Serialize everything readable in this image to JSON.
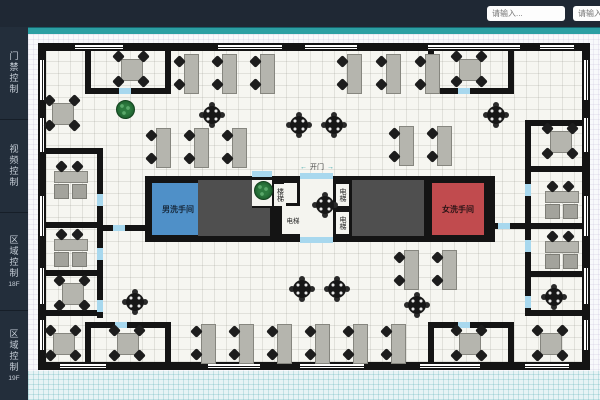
{
  "topbar": {
    "inputs": [
      {
        "placeholder": "请输入..."
      },
      {
        "placeholder": "请输入..."
      }
    ]
  },
  "sidebar": {
    "items": [
      {
        "label": "门禁控制",
        "sub": ""
      },
      {
        "label": "视频控制",
        "sub": ""
      },
      {
        "label": "区域控制",
        "sub": "18F"
      },
      {
        "label": "区域控制",
        "sub": "19F"
      }
    ]
  },
  "floorplan": {
    "labels": {
      "mens_room": "男洗手间",
      "womens_room": "女洗手间",
      "elevator_room": "电梯",
      "shaft_label_1": "电梯",
      "shaft_label_2": "电梯",
      "stairs": "楼梯",
      "open_door": "开门",
      "arrow_left": "←",
      "arrow_right": "→"
    },
    "colors": {
      "topbar_bg": "#1f2834",
      "sidebar_bg": "#232e3b",
      "accent_stripe": "#2b9fa3",
      "wall": "#141414",
      "mens_room": "#4f90c8",
      "womens_room": "#c14b4e",
      "shaft": "#4f4f4f",
      "door_marker": "#a8d8ee",
      "plant": "#1d5e2d"
    },
    "walls": [
      [
        38,
        43,
        552,
        8
      ],
      [
        38,
        362,
        552,
        8
      ],
      [
        38,
        43,
        8,
        327
      ],
      [
        582,
        43,
        8,
        327
      ],
      [
        85,
        43,
        6,
        51
      ],
      [
        85,
        88,
        34,
        6
      ],
      [
        131,
        88,
        40,
        6
      ],
      [
        165,
        43,
        6,
        51
      ],
      [
        428,
        43,
        6,
        51
      ],
      [
        428,
        88,
        30,
        6
      ],
      [
        470,
        88,
        44,
        6
      ],
      [
        508,
        43,
        6,
        51
      ],
      [
        85,
        322,
        6,
        46
      ],
      [
        85,
        322,
        30,
        6
      ],
      [
        127,
        322,
        44,
        6
      ],
      [
        165,
        322,
        6,
        46
      ],
      [
        428,
        322,
        30,
        6
      ],
      [
        470,
        322,
        44,
        6
      ],
      [
        428,
        322,
        6,
        46
      ],
      [
        508,
        322,
        6,
        46
      ],
      [
        97,
        148,
        6,
        46
      ],
      [
        97,
        206,
        6,
        42
      ],
      [
        97,
        260,
        6,
        40
      ],
      [
        97,
        312,
        6,
        6
      ],
      [
        46,
        148,
        51,
        6
      ],
      [
        46,
        222,
        51,
        6
      ],
      [
        46,
        270,
        51,
        6
      ],
      [
        46,
        310,
        51,
        6
      ],
      [
        525,
        120,
        57,
        6
      ],
      [
        525,
        120,
        6,
        64
      ],
      [
        525,
        196,
        6,
        44
      ],
      [
        525,
        252,
        6,
        44
      ],
      [
        525,
        308,
        6,
        8
      ],
      [
        531,
        166,
        51,
        6
      ],
      [
        531,
        223,
        51,
        6
      ],
      [
        531,
        271,
        51,
        6
      ],
      [
        531,
        310,
        51,
        6
      ],
      [
        103,
        225,
        42,
        6
      ],
      [
        487,
        223,
        38,
        6
      ]
    ],
    "windows": [
      [
        75,
        44,
        48,
        6,
        "h"
      ],
      [
        218,
        44,
        64,
        6,
        "h"
      ],
      [
        305,
        44,
        52,
        6,
        "h"
      ],
      [
        428,
        44,
        92,
        6,
        "h"
      ],
      [
        540,
        44,
        34,
        6,
        "h"
      ],
      [
        60,
        363,
        46,
        6,
        "h"
      ],
      [
        208,
        363,
        52,
        6,
        "h"
      ],
      [
        300,
        363,
        64,
        6,
        "h"
      ],
      [
        420,
        363,
        60,
        6,
        "h"
      ],
      [
        525,
        363,
        44,
        6,
        "h"
      ],
      [
        39,
        60,
        6,
        40,
        "v"
      ],
      [
        39,
        118,
        6,
        34,
        "v"
      ],
      [
        39,
        196,
        6,
        40,
        "v"
      ],
      [
        39,
        268,
        6,
        36,
        "v"
      ],
      [
        39,
        320,
        6,
        30,
        "v"
      ],
      [
        583,
        60,
        6,
        40,
        "v"
      ],
      [
        583,
        118,
        6,
        34,
        "v"
      ],
      [
        583,
        196,
        6,
        40,
        "v"
      ],
      [
        583,
        268,
        6,
        36,
        "v"
      ],
      [
        583,
        320,
        6,
        30,
        "v"
      ]
    ],
    "doors": [
      [
        119,
        88,
        12,
        6
      ],
      [
        458,
        88,
        12,
        6
      ],
      [
        115,
        322,
        12,
        6
      ],
      [
        458,
        322,
        12,
        6
      ],
      [
        97,
        194,
        6,
        12
      ],
      [
        97,
        248,
        6,
        12
      ],
      [
        97,
        300,
        6,
        12
      ],
      [
        525,
        184,
        6,
        12
      ],
      [
        525,
        240,
        6,
        12
      ],
      [
        525,
        296,
        6,
        12
      ],
      [
        300,
        173,
        33,
        6
      ],
      [
        300,
        237,
        33,
        6
      ],
      [
        252,
        171,
        20,
        6
      ],
      [
        113,
        225,
        12,
        6
      ],
      [
        498,
        223,
        12,
        6
      ]
    ],
    "furniture": [
      {
        "t": "q",
        "x": 114,
        "y": 52
      },
      {
        "t": "q",
        "x": 452,
        "y": 52
      },
      {
        "t": "q",
        "x": 543,
        "y": 124
      },
      {
        "t": "q",
        "x": 45,
        "y": 96
      },
      {
        "t": "q",
        "x": 55,
        "y": 276
      },
      {
        "t": "q",
        "x": 110,
        "y": 326
      },
      {
        "t": "q",
        "x": 46,
        "y": 326
      },
      {
        "t": "q",
        "x": 452,
        "y": 326
      },
      {
        "t": "q",
        "x": 533,
        "y": 326
      },
      {
        "t": "o",
        "x": 50,
        "y": 162
      },
      {
        "t": "o",
        "x": 50,
        "y": 230
      },
      {
        "t": "o",
        "x": 541,
        "y": 182
      },
      {
        "t": "o",
        "x": 541,
        "y": 232
      },
      {
        "t": "d",
        "x": 175,
        "y": 54
      },
      {
        "t": "d",
        "x": 213,
        "y": 54
      },
      {
        "t": "d",
        "x": 251,
        "y": 54
      },
      {
        "t": "d",
        "x": 338,
        "y": 54
      },
      {
        "t": "d",
        "x": 377,
        "y": 54
      },
      {
        "t": "d",
        "x": 416,
        "y": 54
      },
      {
        "t": "d",
        "x": 147,
        "y": 128
      },
      {
        "t": "d",
        "x": 185,
        "y": 128
      },
      {
        "t": "d",
        "x": 223,
        "y": 128
      },
      {
        "t": "d",
        "x": 390,
        "y": 126
      },
      {
        "t": "d",
        "x": 428,
        "y": 126
      },
      {
        "t": "d",
        "x": 192,
        "y": 324
      },
      {
        "t": "d",
        "x": 230,
        "y": 324
      },
      {
        "t": "d",
        "x": 268,
        "y": 324
      },
      {
        "t": "d",
        "x": 306,
        "y": 324
      },
      {
        "t": "d",
        "x": 344,
        "y": 324
      },
      {
        "t": "d",
        "x": 382,
        "y": 324
      },
      {
        "t": "d",
        "x": 395,
        "y": 250
      },
      {
        "t": "d",
        "x": 433,
        "y": 250
      },
      {
        "t": "r",
        "x": 203,
        "y": 106
      },
      {
        "t": "r",
        "x": 290,
        "y": 116
      },
      {
        "t": "r",
        "x": 325,
        "y": 116
      },
      {
        "t": "r",
        "x": 487,
        "y": 106
      },
      {
        "t": "r",
        "x": 316,
        "y": 196
      },
      {
        "t": "r",
        "x": 293,
        "y": 280
      },
      {
        "t": "r",
        "x": 328,
        "y": 280
      },
      {
        "t": "r",
        "x": 408,
        "y": 296
      },
      {
        "t": "r",
        "x": 126,
        "y": 293
      },
      {
        "t": "r",
        "x": 545,
        "y": 288
      },
      {
        "t": "p",
        "x": 116,
        "y": 100
      },
      {
        "t": "p",
        "x": 254,
        "y": 181
      }
    ]
  }
}
